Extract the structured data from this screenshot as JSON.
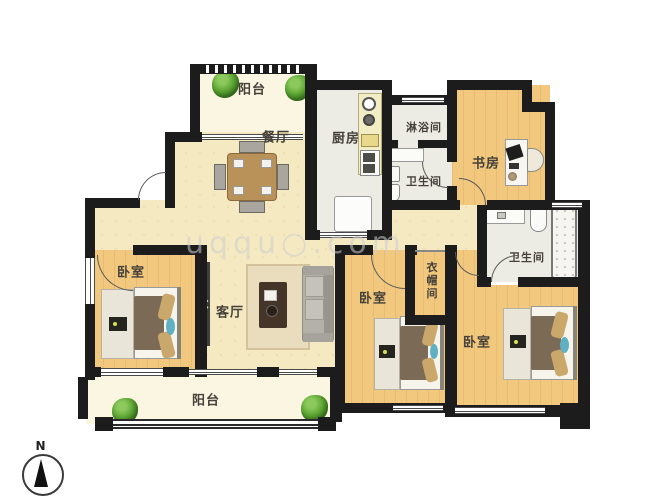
{
  "floorplan": {
    "type": "apartment-floorplan",
    "compass_label": "N",
    "watermark": "uqqu○.com",
    "rooms": {
      "balcony_top": {
        "label": "阳台"
      },
      "dining": {
        "label": "餐厅"
      },
      "kitchen": {
        "label": "厨房"
      },
      "shower_room": {
        "label": "淋浴间"
      },
      "bathroom_top": {
        "label": "卫生间"
      },
      "study": {
        "label": "书房"
      },
      "bathroom_right": {
        "label": "卫生间"
      },
      "cloakroom": {
        "label": "衣帽间"
      },
      "bedroom_left": {
        "label": "卧室"
      },
      "living_room": {
        "label": "客厅"
      },
      "bedroom_middle": {
        "label": "卧室"
      },
      "bedroom_right": {
        "label": "卧室"
      },
      "balcony_bottom": {
        "label": "阳台"
      }
    },
    "colors": {
      "wall": "#1c1c1c",
      "wood_floor": "#f1c87e",
      "public_floor": "#f5e9c2",
      "tile_floor": "#edece4",
      "balcony_floor": "#faf6e2",
      "accent_teal": "#5fb0c2",
      "plant_green": "#54a22e",
      "label_text": "#45403a"
    }
  }
}
